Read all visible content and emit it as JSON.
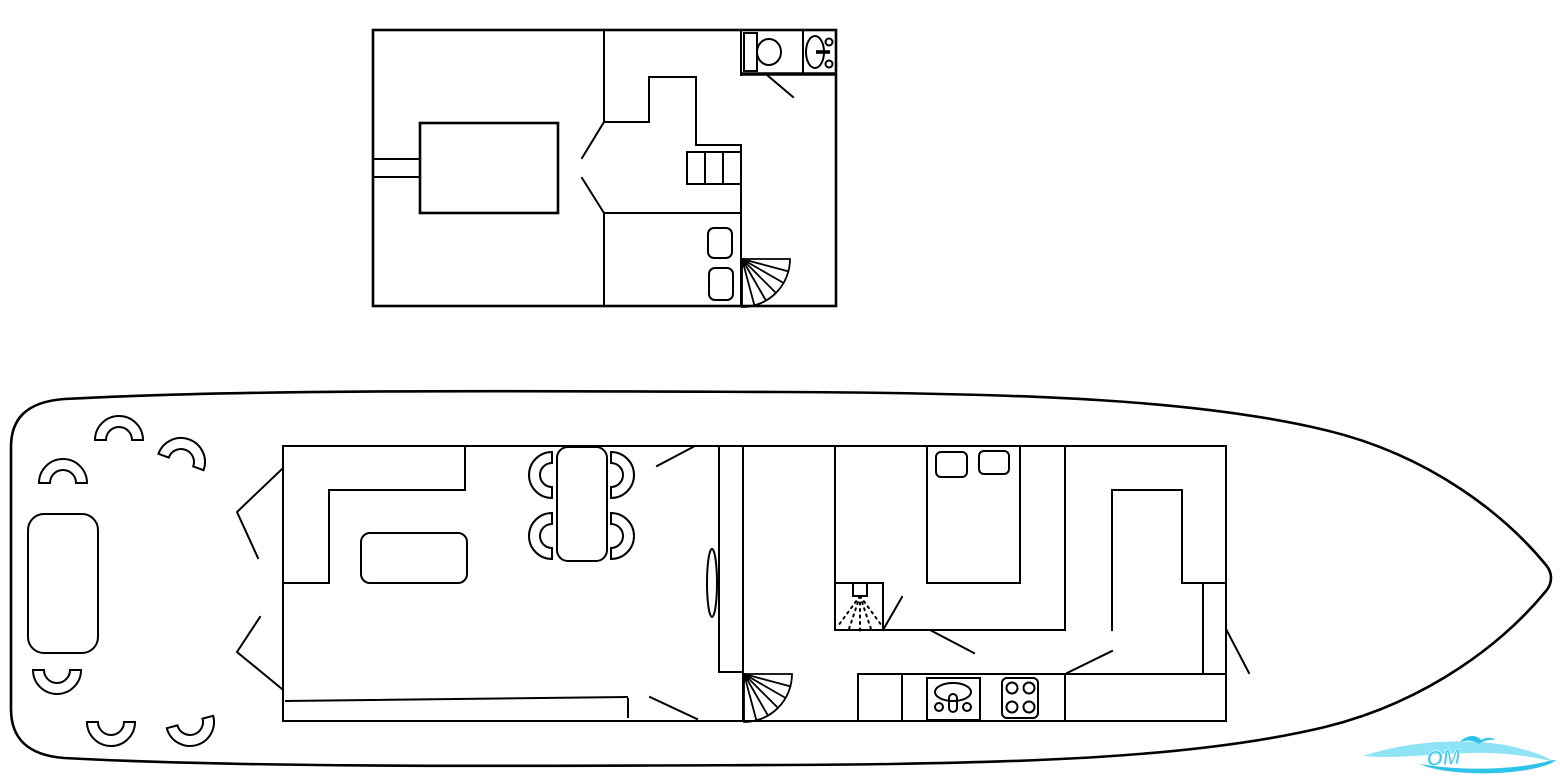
{
  "document": {
    "background": "#ffffff",
    "line_color": "#000000"
  },
  "watermark": {
    "text": "OM",
    "text_color": "#45cdec",
    "wave_light": "#8ee4f5",
    "wave_dark": "#2fc3e8"
  },
  "upper_plan": {
    "furniture_icons": [
      "double-bed",
      "side-shelf",
      "angled-doorway",
      "companionway-steps",
      "seat",
      "seat",
      "spiral-staircase",
      "toilet",
      "washbasin",
      "door-swing"
    ]
  },
  "main_plan": {
    "hull_icon": "boat-hull-outline",
    "aft_deck_icons": [
      "deck-table",
      "seat",
      "seat",
      "seat",
      "seat",
      "seat",
      "seat",
      "angled-screen",
      "angled-screen"
    ],
    "salon_icons": [
      "l-sofa",
      "coffee-table",
      "dining-table",
      "chair",
      "chair",
      "chair",
      "chair",
      "door-swing",
      "bench-line"
    ],
    "midship_icons": [
      "sliding-door",
      "spiral-staircase",
      "shower",
      "door-swing",
      "door-swing"
    ],
    "cabin_icons": [
      "double-bed",
      "pillow",
      "pillow",
      "wardrobe"
    ],
    "galley_icons": [
      "sink",
      "stove",
      "counter",
      "door-swing",
      "door-swing"
    ]
  }
}
